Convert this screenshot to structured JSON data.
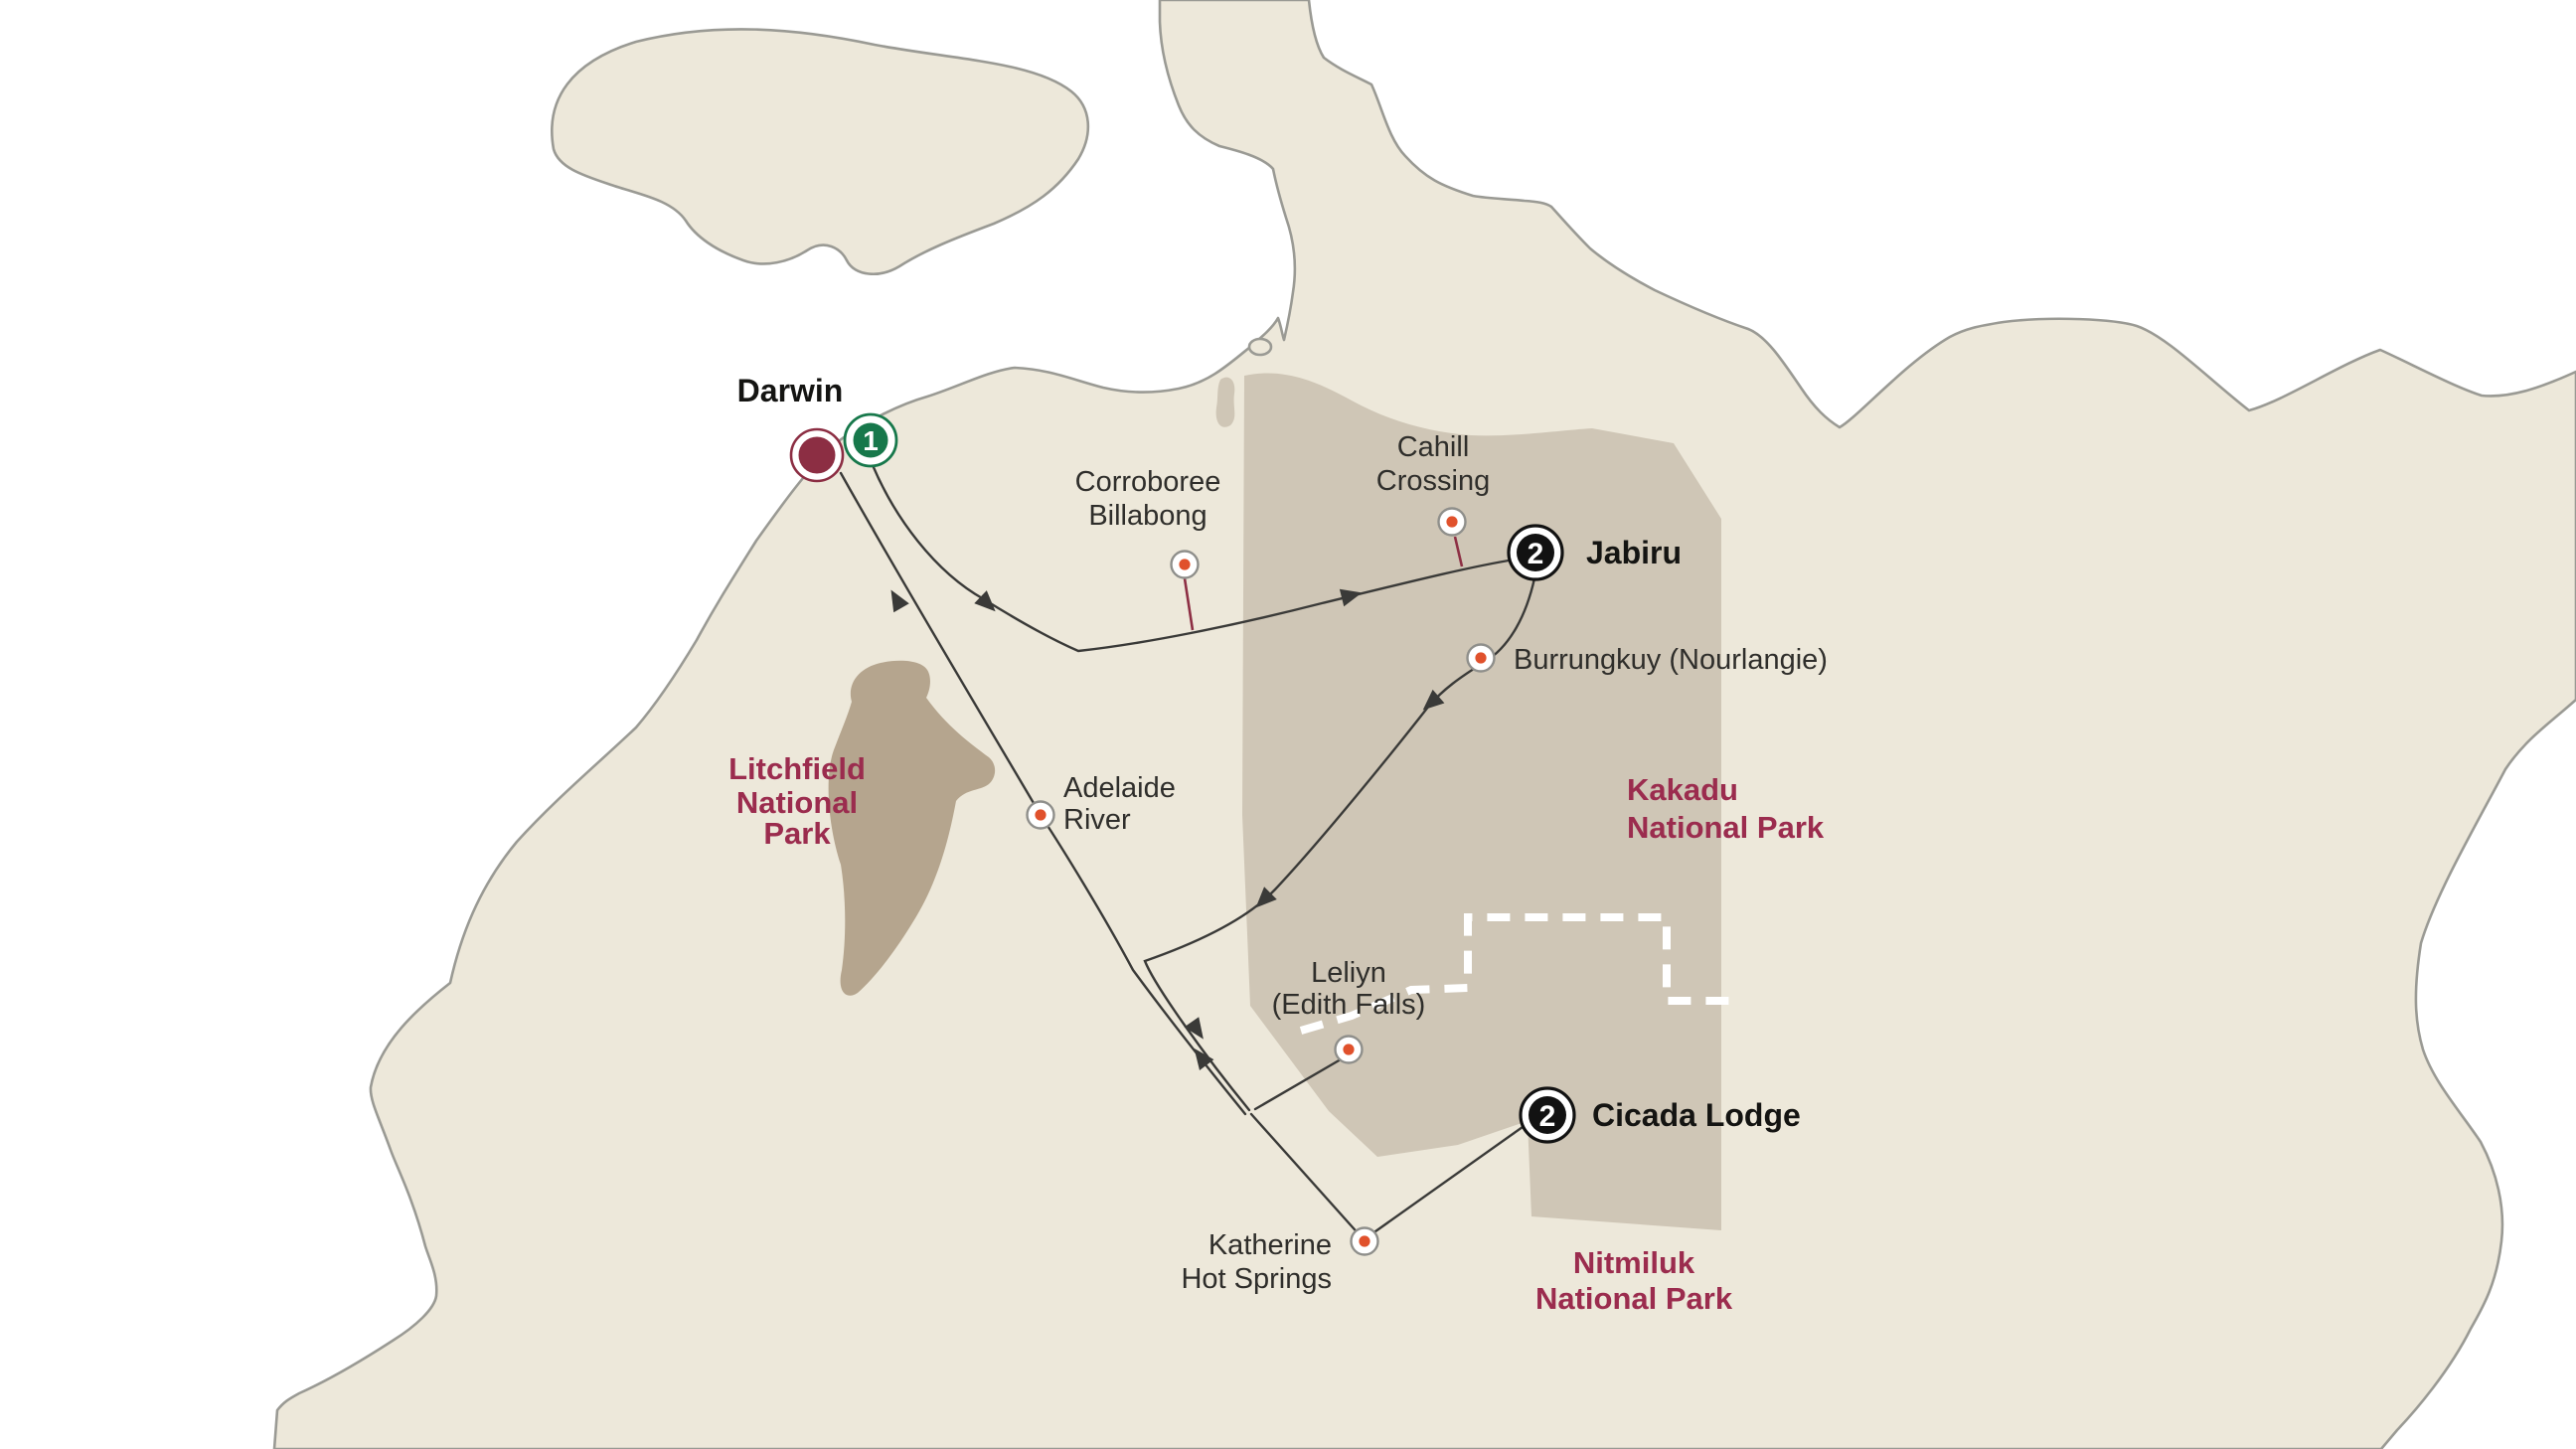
{
  "stops": [
    {
      "id": "darwin",
      "label": "Darwin",
      "nights": "1",
      "badge": "green"
    },
    {
      "id": "jabiru",
      "label": "Jabiru",
      "nights": "2",
      "badge": "black"
    },
    {
      "id": "cicada-lodge",
      "label": "Cicada Lodge",
      "nights": "2",
      "badge": "black"
    }
  ],
  "pois": [
    {
      "id": "corroboree-billabong",
      "lines": [
        "Corroboree",
        "Billabong"
      ]
    },
    {
      "id": "cahill-crossing",
      "lines": [
        "Cahill",
        "Crossing"
      ]
    },
    {
      "id": "burrungkuy",
      "lines": [
        "Burrungkuy (Nourlangie)"
      ]
    },
    {
      "id": "adelaide-river",
      "lines": [
        "Adelaide",
        "River"
      ]
    },
    {
      "id": "leliyn-edith-falls",
      "lines": [
        "Leliyn",
        "(Edith Falls)"
      ]
    },
    {
      "id": "katherine-hot-springs",
      "lines": [
        "Katherine",
        "Hot Springs"
      ]
    }
  ],
  "parks": [
    {
      "id": "litchfield",
      "lines": [
        "Litchfield",
        "National",
        "Park"
      ]
    },
    {
      "id": "kakadu",
      "lines": [
        "Kakadu",
        "National Park"
      ]
    },
    {
      "id": "nitmiluk",
      "lines": [
        "Nitmiluk",
        "National Park"
      ]
    }
  ],
  "colors": {
    "ocean": "#ffffff",
    "land": "#ede8da",
    "coast": "#9a9a94",
    "park_fill": "#cfc6b6",
    "litchfield_fill": "#b5a58e",
    "route": "#3a3a38",
    "pin_stem": "#8d2f44",
    "poi_ring": "#8f8f8b",
    "poi_dot": "#e0512c",
    "stop_darwin": "#8c2e43",
    "badge_green": "#17784b",
    "badge_black": "#121212",
    "park_label": "#9b2c4e",
    "label_dark": "#2f2e2b",
    "boundary_dash": "#ffffff"
  }
}
